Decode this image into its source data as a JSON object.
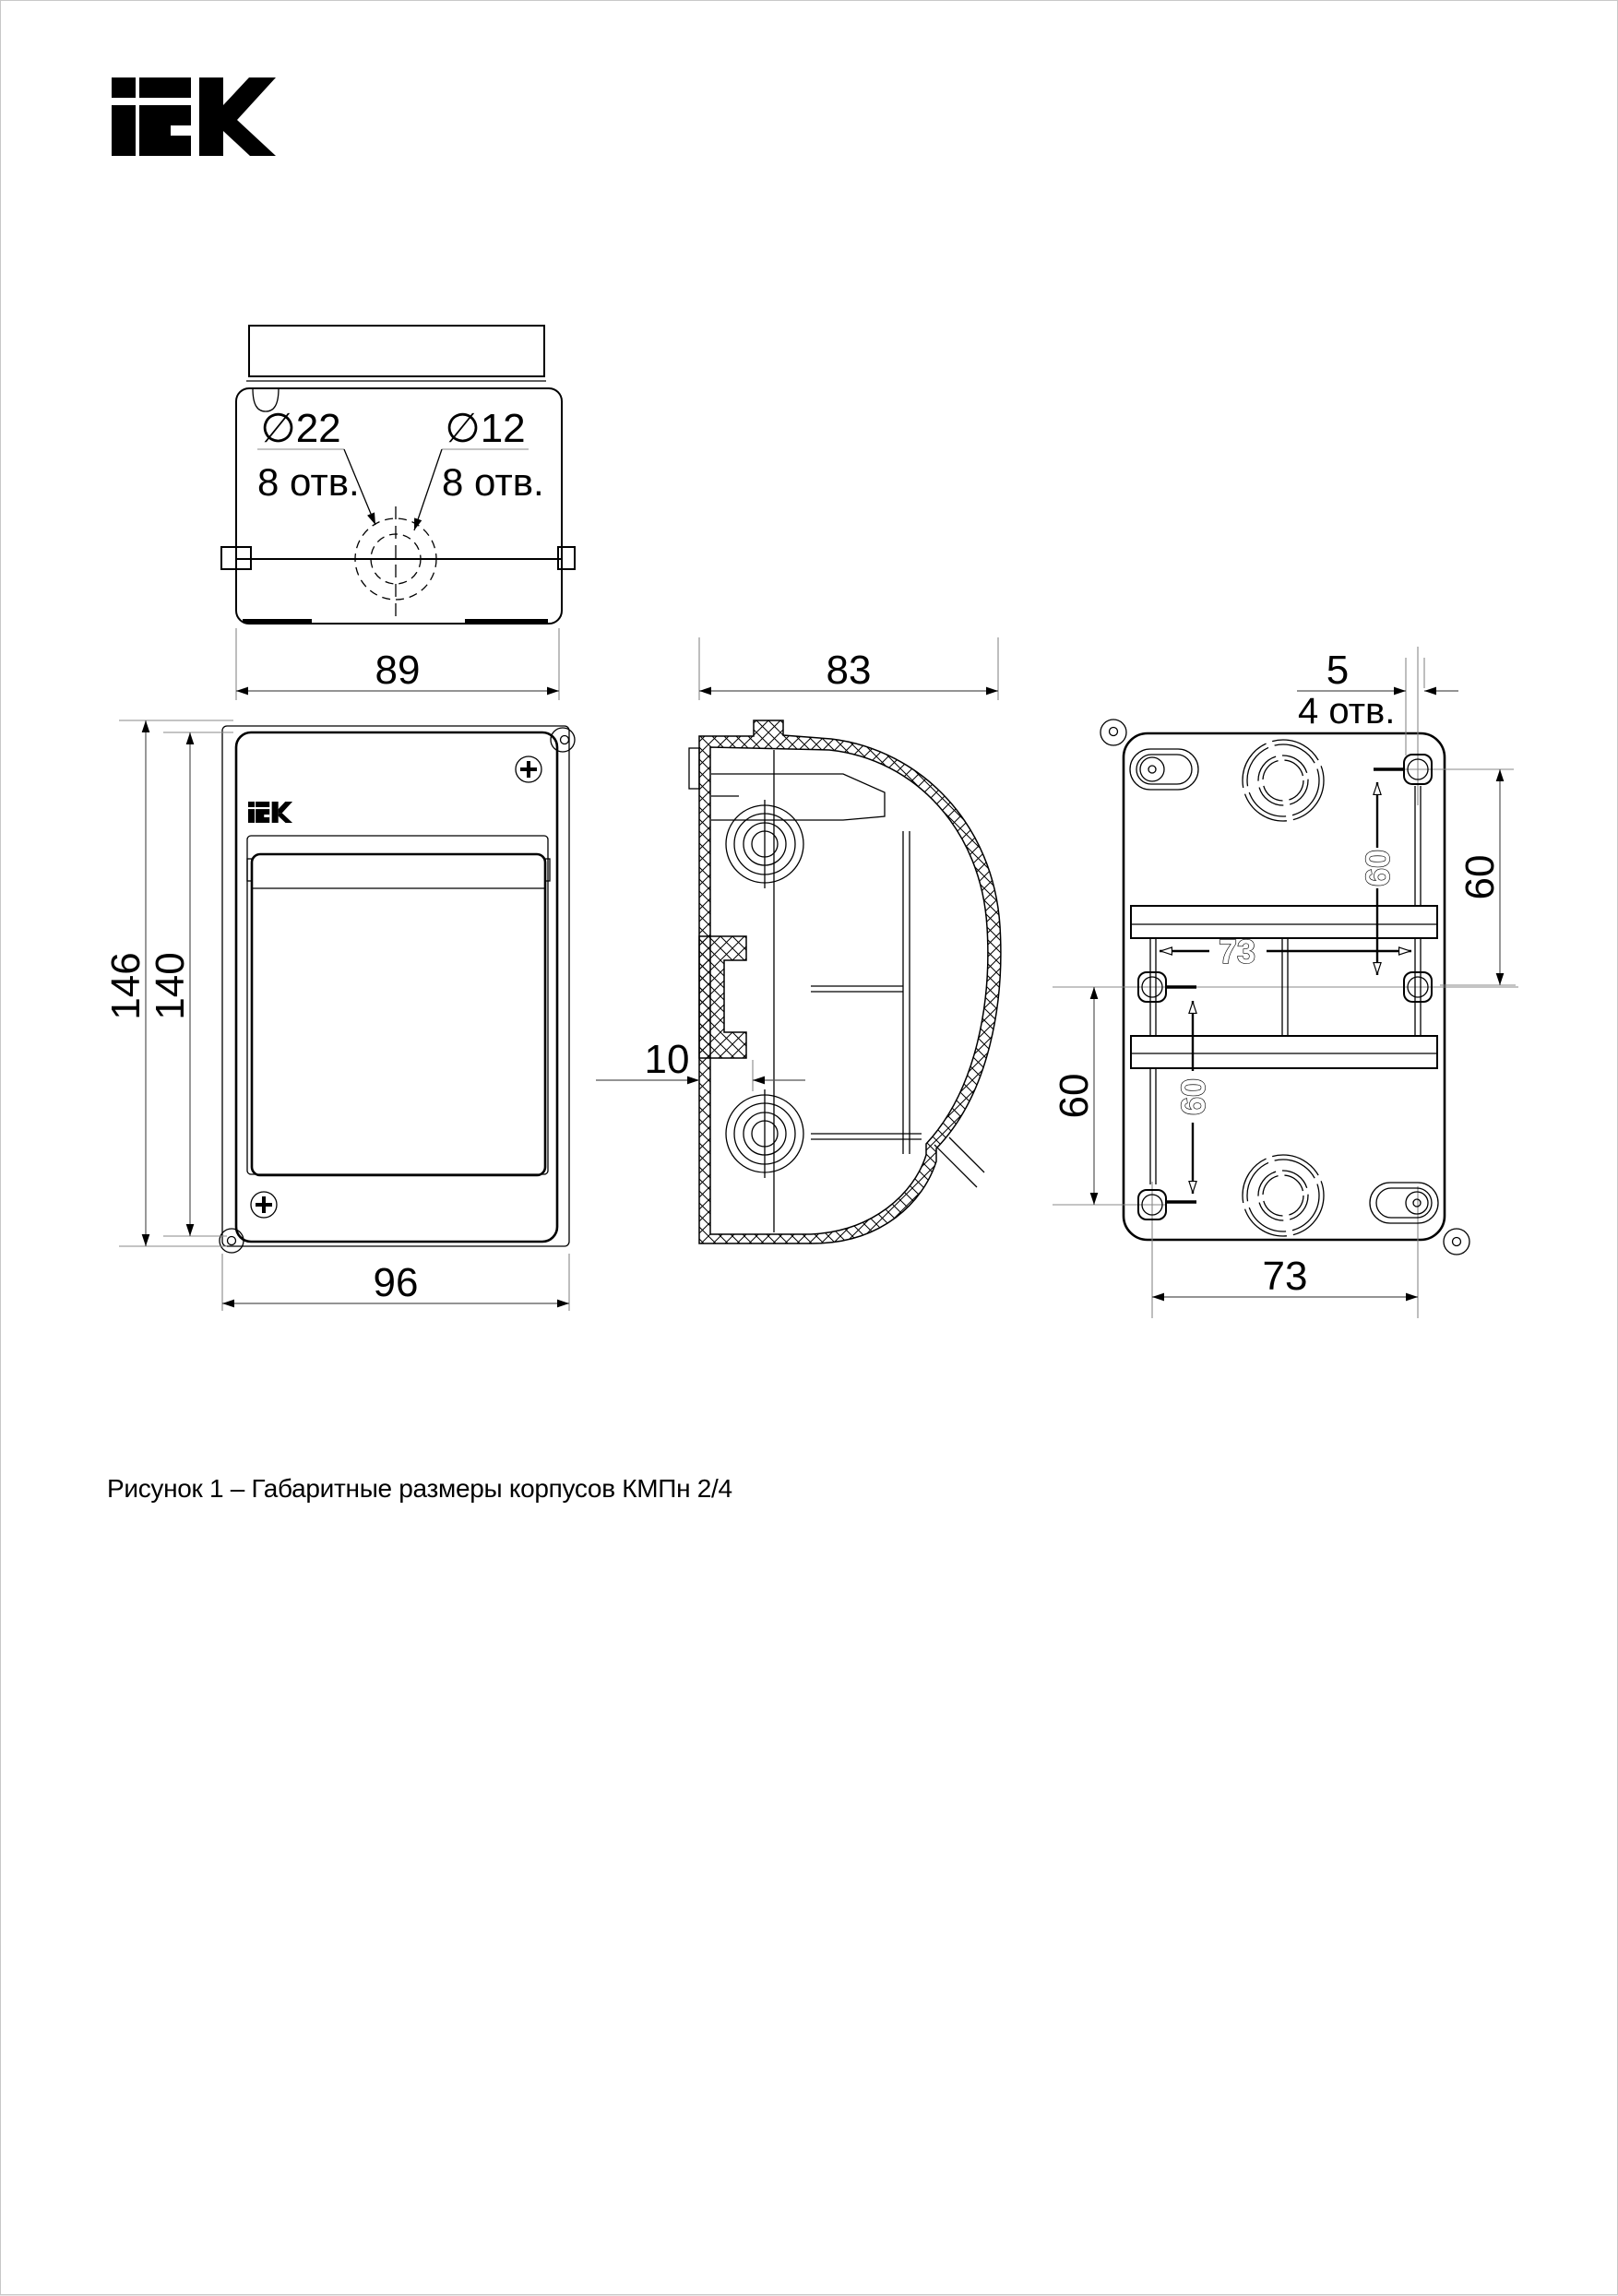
{
  "brand": "IEK",
  "caption": "Рисунок 1 – Габаритные размеры корпусов КМПн 2/4",
  "top_view": {
    "hole_large_dia": "∅22",
    "hole_large_count": "8 отв.",
    "hole_small_dia": "∅12",
    "hole_small_count": "8 отв."
  },
  "front_view": {
    "dim_width_top": "89",
    "dim_height_outer": "146",
    "dim_height_inner": "140",
    "dim_width_bottom": "96"
  },
  "side_view": {
    "dim_depth": "83",
    "dim_rail_offset": "10"
  },
  "back_view": {
    "dim_slot_width": "5",
    "holes_count": "4 отв.",
    "dim_right_vertical": "60",
    "dim_left_vertical": "60",
    "dim_inner_horizontal": "73",
    "dim_inner_vertical_top": "60",
    "dim_inner_vertical_bottom": "60",
    "dim_bottom_horizontal": "73"
  }
}
